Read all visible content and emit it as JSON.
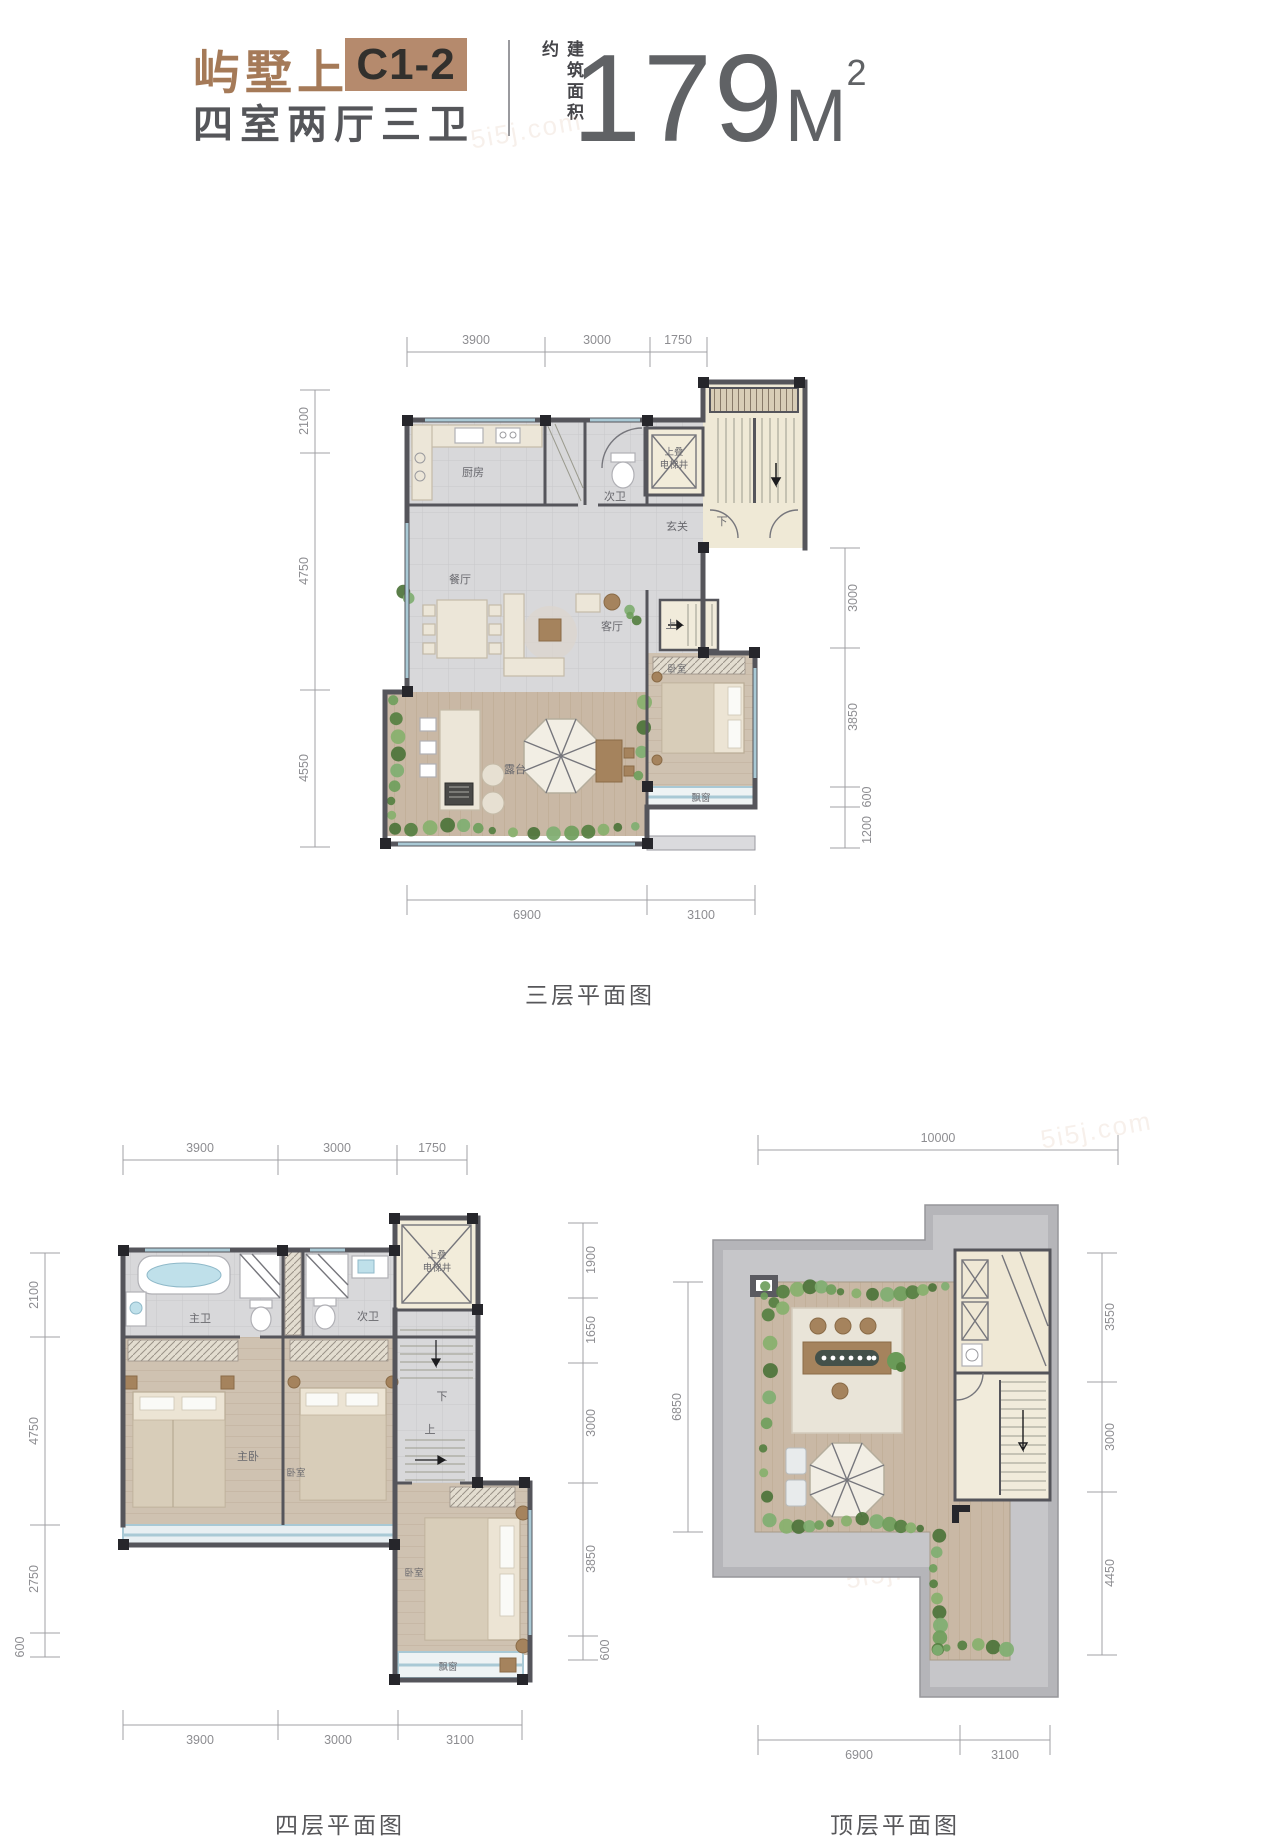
{
  "header": {
    "brand": "屿墅上",
    "unit": "C1-2",
    "rooms": "四室两厅三卫",
    "area_label": "建筑面积约",
    "area_value": "179",
    "area_unit": "M",
    "area_sup": "2",
    "brand_color": "#a57a58",
    "unit_box_color": "#b58a6d"
  },
  "watermark": "5i5j.com",
  "f3": {
    "caption": "三层平面图",
    "dt": [
      "3900",
      "3000",
      "1750"
    ],
    "dl": [
      "2100",
      "4750",
      "4550"
    ],
    "dr": [
      "3000",
      "3850",
      "600",
      "1200"
    ],
    "db": [
      "6900",
      "3100"
    ],
    "r": {
      "kitchen": "厨房",
      "bath": "次卫",
      "foyer": "玄关",
      "elev1": "上叠",
      "elev2": "电梯井",
      "dining": "餐厅",
      "living": "客厅",
      "bed": "卧室",
      "terrace": "露台",
      "bay": "飘窗",
      "up": "上",
      "down": "下"
    }
  },
  "f4": {
    "caption": "四层平面图",
    "dt": [
      "3900",
      "3000",
      "1750"
    ],
    "dl": [
      "2100",
      "4750",
      "2750",
      "600"
    ],
    "dr": [
      "1900",
      "1650",
      "3000",
      "3850",
      "600"
    ],
    "db": [
      "3900",
      "3000",
      "3100"
    ],
    "r": {
      "mbath": "主卫",
      "bath": "次卫",
      "elev1": "上叠",
      "elev2": "电梯井",
      "master": "主卧",
      "bed2": "卧室",
      "bed3": "卧室",
      "bay": "飘窗",
      "up": "上",
      "down": "下"
    }
  },
  "f5": {
    "caption": "顶层平面图",
    "dt": [
      "10000"
    ],
    "dl": [
      "6850"
    ],
    "dr": [
      "3550",
      "3000",
      "4450"
    ],
    "db": [
      "6900",
      "3100"
    ]
  }
}
